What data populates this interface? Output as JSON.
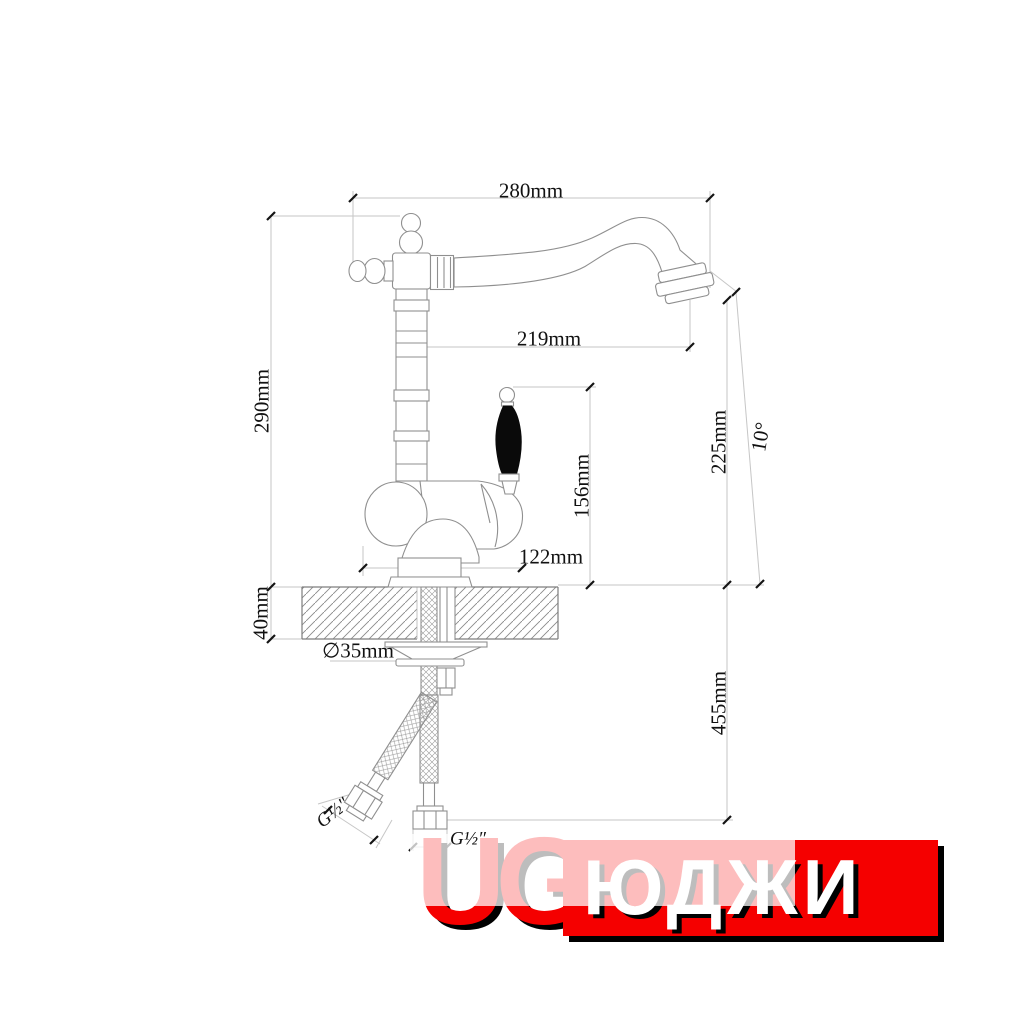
{
  "drawing": {
    "dimensions": {
      "width_top": "280mm",
      "spout_reach": "219mm",
      "height_total": "290mm",
      "deck_thickness": "40mm",
      "outlet_height": "225mm",
      "tilt_angle": "10°",
      "handle_height": "156mm",
      "body_width": "122mm",
      "hole_diameter": "∅35mm",
      "hose_length": "455mm",
      "thread_side": "G½″",
      "thread_bottom": "G½″"
    }
  },
  "logo": {
    "latin": "UG",
    "cyrillic": "ЮДЖИ",
    "accent_color": "#f50000",
    "shadow_color": "#000000"
  }
}
